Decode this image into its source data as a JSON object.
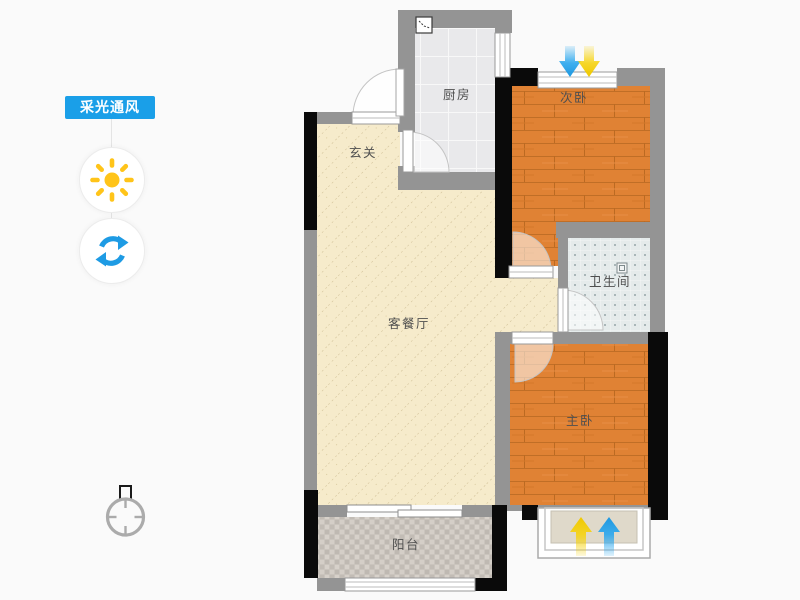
{
  "sidebar": {
    "badge_label": "采光通风",
    "sun_icon": "sun-icon",
    "refresh_icon": "refresh-icon"
  },
  "floorplan": {
    "rooms": [
      {
        "id": "kitchen",
        "label": "厨房"
      },
      {
        "id": "bedroom2",
        "label": "次卧"
      },
      {
        "id": "entry",
        "label": "玄关"
      },
      {
        "id": "living_dining",
        "label": "客餐厅"
      },
      {
        "id": "bathroom",
        "label": "卫生间"
      },
      {
        "id": "master_bedroom",
        "label": "主卧"
      },
      {
        "id": "balcony",
        "label": "阳台"
      }
    ],
    "indicators": {
      "top_window_arrows": [
        "ventilation-blue-down",
        "daylight-yellow-down"
      ],
      "bottom_baywindow_arrows": [
        "daylight-yellow-up",
        "ventilation-blue-up"
      ]
    }
  },
  "colors": {
    "accent_blue": "#1A9FE8",
    "sun_yellow": "#FFC419",
    "arrow_blue": "#2AA7EE",
    "arrow_yellow": "#F6D311",
    "wall_gray": "#949494",
    "wall_black": "#0A0A0A",
    "wood_floor": "#E08234",
    "living_floor": "#F6EBCB",
    "kitchen_tile": "#E9E9EB",
    "bath_tile": "#E5EBEB",
    "balcony_tile": "#CAC4BD",
    "bay_fill": "#DFD9CA"
  }
}
